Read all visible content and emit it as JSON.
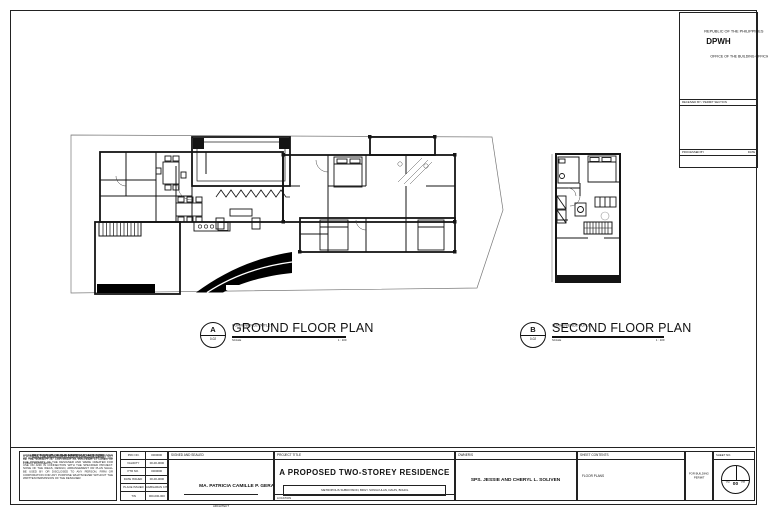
{
  "agency": {
    "line1": "REPUBLIC OF THE PHILIPPINES",
    "line2": "DPWH",
    "line3": "OFFICE OF THE BUILDING OFFICIAL",
    "band1_label": "RECEIVED BY / PERMIT SECTION",
    "band1_date": "DATE",
    "band2_label": "PROCESSED BY",
    "band2_date": "DATE"
  },
  "plans": {
    "ground": {
      "marker_letter": "A",
      "marker_ref": "0-02",
      "note": "CONVENIENCE OUTLET",
      "title": "GROUND FLOOR PLAN",
      "scale_label": "SCALE",
      "scale_value": "1 : 100"
    },
    "second": {
      "marker_letter": "B",
      "marker_ref": "0-02",
      "note": "CONVENIENCE OUTLET",
      "title": "SECOND FLOOR PLAN",
      "scale_label": "SCALE",
      "scale_value": "1 : 100"
    }
  },
  "titleblock": {
    "section35": {
      "heading": "SECTION 35 OF THE REPUBLIC ACT 8293",
      "subline": "A WORK OF THE GOVERNMENT OF THE PHILIPPINES SHALL NOT BE THE SUBJECT OF COPYRIGHT AS PROVIDED IN CASES OF PUBLIC DOCUMENTS.",
      "body": "HOWEVER, ALL IDEAS, ARRANGEMENT AND DESIGN INDICATED OR REPRESENTED BY THIS DRAWING ARE OWNED BY AND ARE THE PROPERTY OF THE DESIGNER AND WERE CREATED FOR USE ON AND IN CONNECTION WITH THE SPECIFIED PROJECT. NONE OF THE IDEAS, DESIGN, ARRANGEMENT OR PLAN SHALL BE USED BY OR DISCLOSED TO ANY PERSON, FIRM OR CORPORATION FOR ANY PURPOSE WHATSOEVER WITHOUT THE WRITTEN PERMISSION OF THE DESIGNER."
    },
    "professional": {
      "rows": [
        {
          "label": "PRC NO.",
          "value": "0000000"
        },
        {
          "label": "VALIDITY",
          "value": "00-00-0000"
        },
        {
          "label": "PTR NO.",
          "value": "0000000"
        },
        {
          "label": "DATE ISSUED",
          "value": "00-00-0000"
        },
        {
          "label": "PLACE ISSUED",
          "value": "TAGBILARAN CITY"
        },
        {
          "label": "TIN",
          "value": "000-000-000"
        }
      ]
    },
    "signed": {
      "header": "SIGNED AND SEALED",
      "name": "MA. PATRICIA CAMILLE P. GERARDINO",
      "role": "ARCHITECT"
    },
    "project": {
      "header": "PROJECT TITLE",
      "title": "A PROPOSED TWO-STOREY RESIDENCE",
      "address": "METROPOLIS SUBDIVISION, BRGY. SONGCULAN, DAUIS, BOHOL",
      "location_label": "LOCATION"
    },
    "owners": {
      "header": "OWNER/S",
      "value": "SPS. JESSIE AND CHERYL L. SOLIVEN"
    },
    "contents": {
      "header": "SHEET CONTENTS",
      "value": "FLOOR PLANS"
    },
    "permit": {
      "line1": "FOR BUILDING",
      "line2": "PERMIT"
    },
    "sheet_no": {
      "header": "SHEET NO.",
      "top_left": "02",
      "top_right": "08",
      "bottom": "00"
    }
  }
}
